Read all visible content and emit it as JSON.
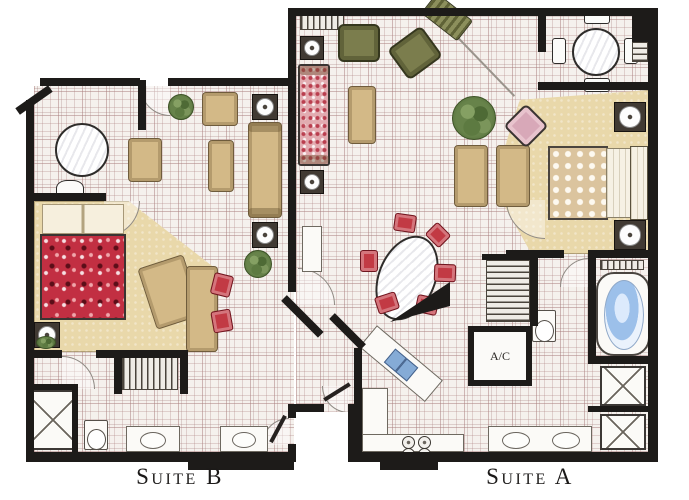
{
  "meta": {
    "type": "floor-plan",
    "units_shown": 2
  },
  "labels": {
    "suite_b": "Suite B",
    "suite_a": "Suite A",
    "ac_closet": "A/C"
  },
  "colors": {
    "wall": "#1d1b19",
    "tile_bg": "#f5f1ed",
    "carpet": "#e9d8aa",
    "sofa_tan": "#d3b987",
    "sofa_pink": "#e2abb0",
    "bed_red": "#c22f42",
    "bed_tan": "#dbc49e",
    "chair_green": "#7b7d4d",
    "chair_red": "#c23a44",
    "tub_blue": "#9cc0ea",
    "sink_blue": "#85abd6",
    "plant_green": "#67834a",
    "lamp_table": "#413a33"
  },
  "suite_b": {
    "name": "Suite B",
    "rooms": [
      "living-dining",
      "bedroom",
      "bathroom",
      "closet",
      "entry"
    ],
    "furniture": [
      "round table",
      "white chair",
      "armchairs",
      "sofa",
      "coffee table",
      "side tables with lamps",
      "plants",
      "bed with red floral spread",
      "pillows",
      "nightstand with lamp",
      "desk with two red chairs",
      "hanging closet",
      "shower",
      "toilet",
      "two vanity sinks"
    ]
  },
  "suite_a": {
    "name": "Suite A",
    "rooms": [
      "living room",
      "breakfast nook",
      "bedroom",
      "bathroom",
      "kitchen",
      "a/c closet",
      "foyer"
    ],
    "furniture": [
      "speckled pink sofa",
      "side tables with lamps",
      "green armchairs",
      "striped chaise",
      "coffee table",
      "large plant",
      "breakfast table with four chairs",
      "bed with dotted spread",
      "two nightstands with lamps",
      "pink ottoman",
      "two tan armchairs",
      "oval dining table with six red chairs",
      "console table",
      "kitchen counter with sink",
      "cooktop burners",
      "pantry shelves",
      "A/C closet",
      "jetted tub",
      "two shower stalls",
      "double vanity sinks",
      "toilet"
    ]
  }
}
